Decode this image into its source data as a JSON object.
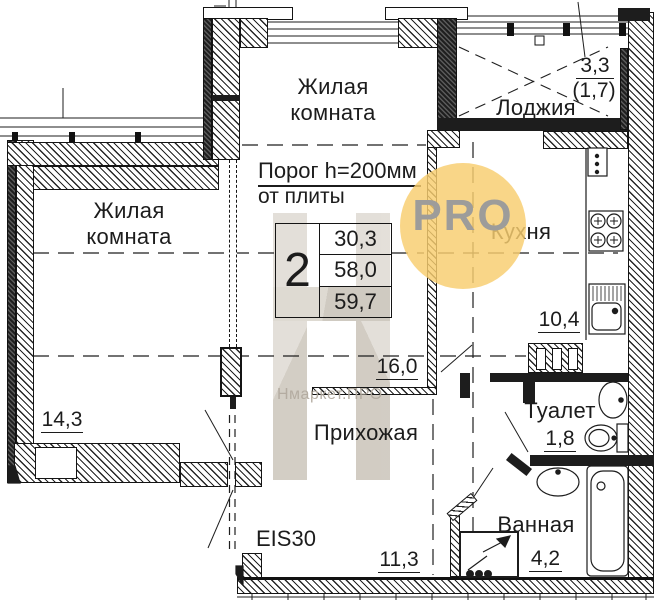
{
  "plan": {
    "rooms": {
      "living_top": {
        "label": "Жилая комната",
        "area": "16,0"
      },
      "living_left": {
        "label": "Жилая комната",
        "area": "14,3"
      },
      "loggia": {
        "label": "Лоджия",
        "area": "3,3",
        "area_coef": "(1,7)"
      },
      "kitchen": {
        "label": "Кухня",
        "area": "10,4"
      },
      "hallway": {
        "label": "Прихожая",
        "area": "11,3"
      },
      "toilet": {
        "label": "Туалет",
        "area": "1,8"
      },
      "bathroom": {
        "label": "Ванная",
        "area": "4,2"
      }
    },
    "note": {
      "line1": "Порог h=200мм",
      "line2": "от плиты"
    },
    "entrance_door_rating": "EIS30",
    "stamp": {
      "rooms_count": "2",
      "values": [
        "30,3",
        "58,0",
        "59,7"
      ]
    },
    "watermarks": {
      "badge_text": "PRO",
      "brand_text": "Нмаркет.ПРО",
      "badge_color": "rgba(248,206,112,0.83)",
      "badge_text_color": "#9D9C9A",
      "brand_text_color": "#B3ABA0",
      "logo_color": "#D4CEC5"
    }
  }
}
